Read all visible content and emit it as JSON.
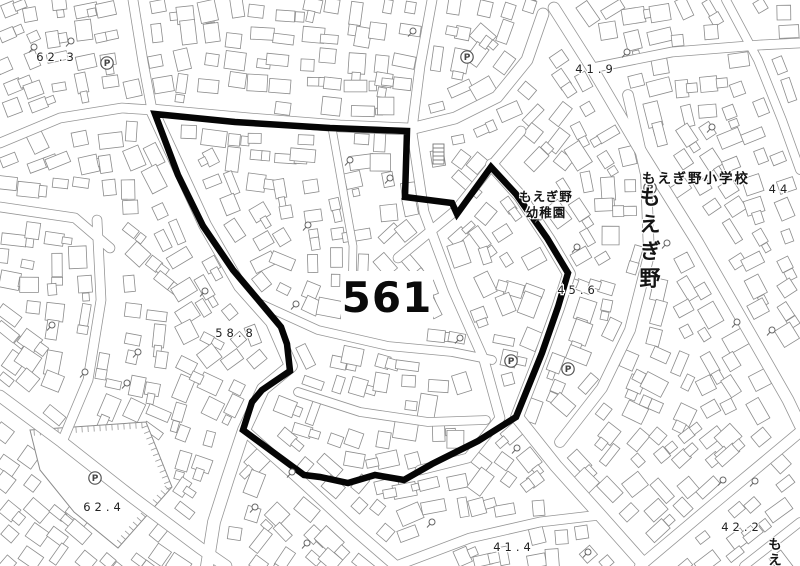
{
  "map": {
    "district_label": {
      "text": "561"
    },
    "place_labels": {
      "school": "もえぎ野小学校",
      "kindergarten_line1": "もえぎ野",
      "kindergarten_line2": "幼稚園",
      "town_vertical": "もえぎ野",
      "edge_vertical_partial": "もえ"
    },
    "elevation_labels": [
      {
        "text": "62.3",
        "x": 57,
        "y": 61
      },
      {
        "text": "41.9",
        "x": 596,
        "y": 73
      },
      {
        "text": "44",
        "x": 780,
        "y": 193
      },
      {
        "text": "45.6",
        "x": 578,
        "y": 294
      },
      {
        "text": "58.8",
        "x": 236,
        "y": 337
      },
      {
        "text": "62.4",
        "x": 104,
        "y": 511
      },
      {
        "text": "41.4",
        "x": 514,
        "y": 551
      },
      {
        "text": "42.2",
        "x": 742,
        "y": 531
      }
    ],
    "parking_symbol": "P",
    "parking_markers": [
      [
        107,
        63
      ],
      [
        467,
        57
      ],
      [
        650,
        188
      ],
      [
        511,
        361
      ],
      [
        568,
        369
      ],
      [
        95,
        478
      ]
    ],
    "utility_markers": [
      [
        34,
        47
      ],
      [
        71,
        41
      ],
      [
        52,
        325
      ],
      [
        85,
        372
      ],
      [
        138,
        352
      ],
      [
        127,
        383
      ],
      [
        205,
        291
      ],
      [
        296,
        304
      ],
      [
        368,
        285
      ],
      [
        308,
        225
      ],
      [
        390,
        178
      ],
      [
        413,
        31
      ],
      [
        540,
        217
      ],
      [
        577,
        247
      ],
      [
        667,
        243
      ],
      [
        712,
        127
      ],
      [
        737,
        322
      ],
      [
        772,
        330
      ],
      [
        723,
        480
      ],
      [
        755,
        481
      ],
      [
        517,
        448
      ],
      [
        292,
        472
      ],
      [
        255,
        507
      ],
      [
        307,
        543
      ],
      [
        432,
        522
      ],
      [
        588,
        552
      ],
      [
        350,
        160
      ],
      [
        460,
        338
      ],
      [
        627,
        52
      ]
    ],
    "boundary": {
      "color": "#050505",
      "stroke_width": 6.5,
      "points": [
        [
          155,
          114
        ],
        [
          235,
          122
        ],
        [
          330,
          128
        ],
        [
          407,
          131
        ],
        [
          405,
          197
        ],
        [
          452,
          203
        ],
        [
          457,
          214
        ],
        [
          491,
          167
        ],
        [
          516,
          194
        ],
        [
          547,
          238
        ],
        [
          568,
          273
        ],
        [
          558,
          307
        ],
        [
          542,
          353
        ],
        [
          516,
          417
        ],
        [
          478,
          441
        ],
        [
          432,
          464
        ],
        [
          404,
          480
        ],
        [
          375,
          475
        ],
        [
          348,
          483
        ],
        [
          320,
          477
        ],
        [
          304,
          475
        ],
        [
          243,
          430
        ],
        [
          252,
          402
        ],
        [
          262,
          390
        ],
        [
          290,
          371
        ],
        [
          287,
          344
        ],
        [
          281,
          327
        ],
        [
          260,
          302
        ],
        [
          233,
          270
        ],
        [
          203,
          226
        ],
        [
          178,
          175
        ]
      ]
    },
    "colors": {
      "background": "#ffffff",
      "building_line": "#8c8c8c",
      "road_edge": "#969696",
      "label_text": "#222222"
    }
  }
}
